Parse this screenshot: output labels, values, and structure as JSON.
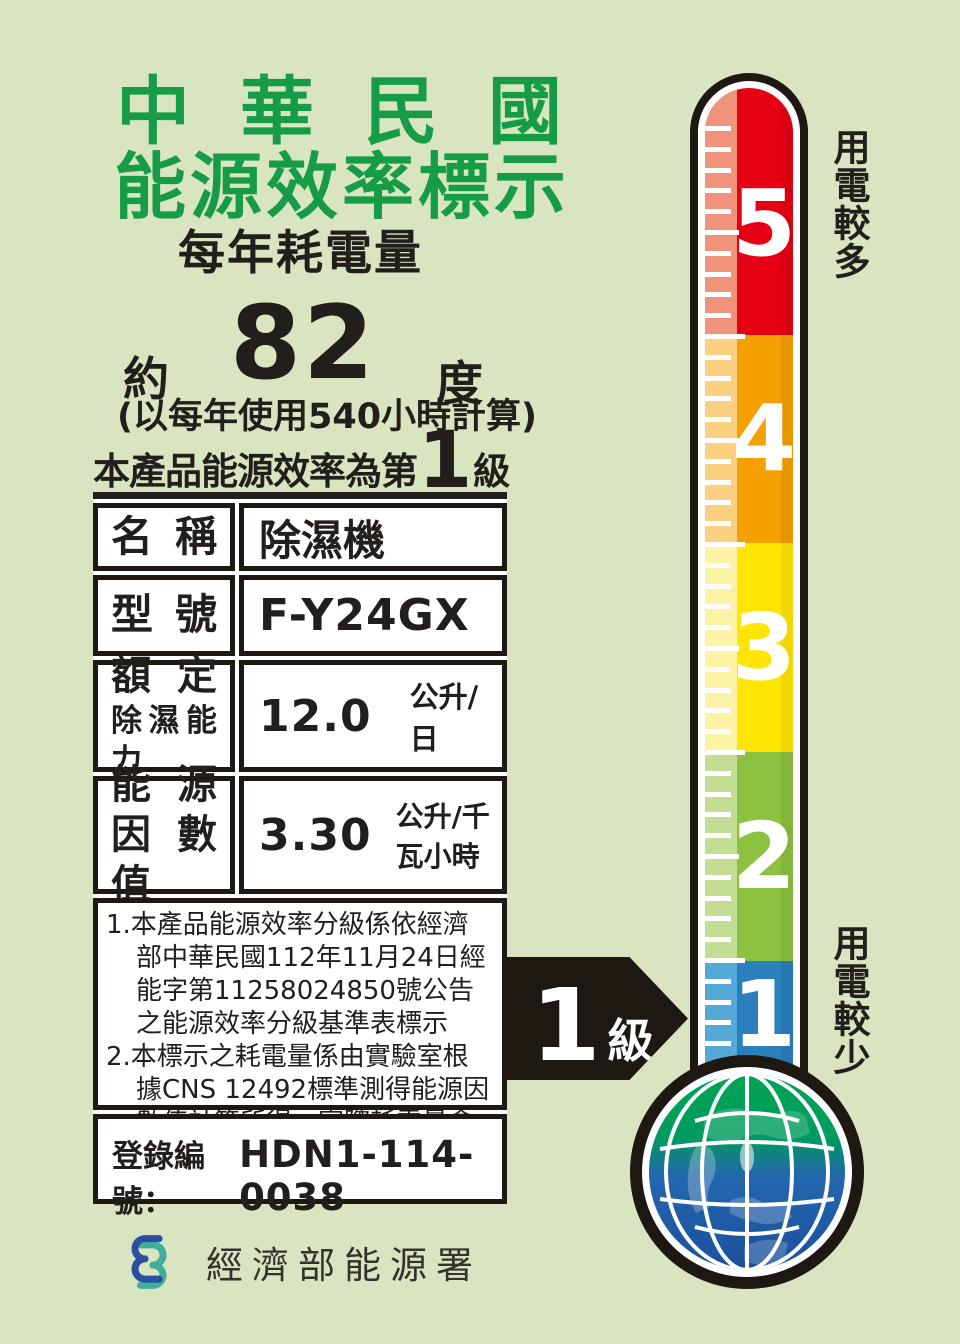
{
  "colors": {
    "bg": "#d9e5c0",
    "title-green": "#169c47",
    "ink": "#221e1b",
    "tube-ink": "#1d1812"
  },
  "header": {
    "title_line1": "中華民國",
    "title_line2": "能源效率標示",
    "subtitle": "每年耗電量"
  },
  "consumption": {
    "prefix": "約",
    "value": "82",
    "unit": "度",
    "basis": "(以每年使用540小時計算)"
  },
  "grade_line": {
    "prefix": "本產品能源效率為第",
    "grade": "1",
    "suffix": "級"
  },
  "table": {
    "rows": [
      {
        "label": "名稱",
        "value": "除濕機"
      },
      {
        "label": "型號",
        "value": "F-Y24GX"
      },
      {
        "label_line1": "額定",
        "label_line2": "除濕能力",
        "value": "12.0",
        "unit": "公升/日"
      },
      {
        "label_line1": "能源",
        "label_line2": "因數值",
        "value": "3.30",
        "unit": "公升/千瓦小時"
      }
    ]
  },
  "notes": [
    "1.本產品能源效率分級係依經濟部中華民國112年11月24日經能字第11258024850號公告之能源效率分級基準表標示",
    "2.本標示之耗電量係由實驗室根據CNS 12492標準測得能源因數值計算所得，實際耗電量會因使用環境條件及使用時數而有所差異。"
  ],
  "registration": {
    "label": "登錄編號：",
    "number": "HDN1-114-0038"
  },
  "footer": {
    "agency": "經濟部能源署",
    "logo_blue": "#2b4f9e",
    "logo_teal": "#3fae9f"
  },
  "thermometer": {
    "top_label": "用電較多",
    "bottom_label": "用電較少",
    "levels": [
      {
        "label": "5",
        "color": "#e60013",
        "strip": "#f0937b"
      },
      {
        "label": "4",
        "color": "#f6a000",
        "strip": "#fbd080"
      },
      {
        "label": "3",
        "color": "#ffe501",
        "strip": "#fdf3a4"
      },
      {
        "label": "2",
        "color": "#8cc23f",
        "strip": "#c3de92"
      },
      {
        "label": "1",
        "color": "#2a80bd",
        "strip": "#55a9d7"
      }
    ],
    "arrow": {
      "grade": "1",
      "suffix": "級"
    }
  }
}
